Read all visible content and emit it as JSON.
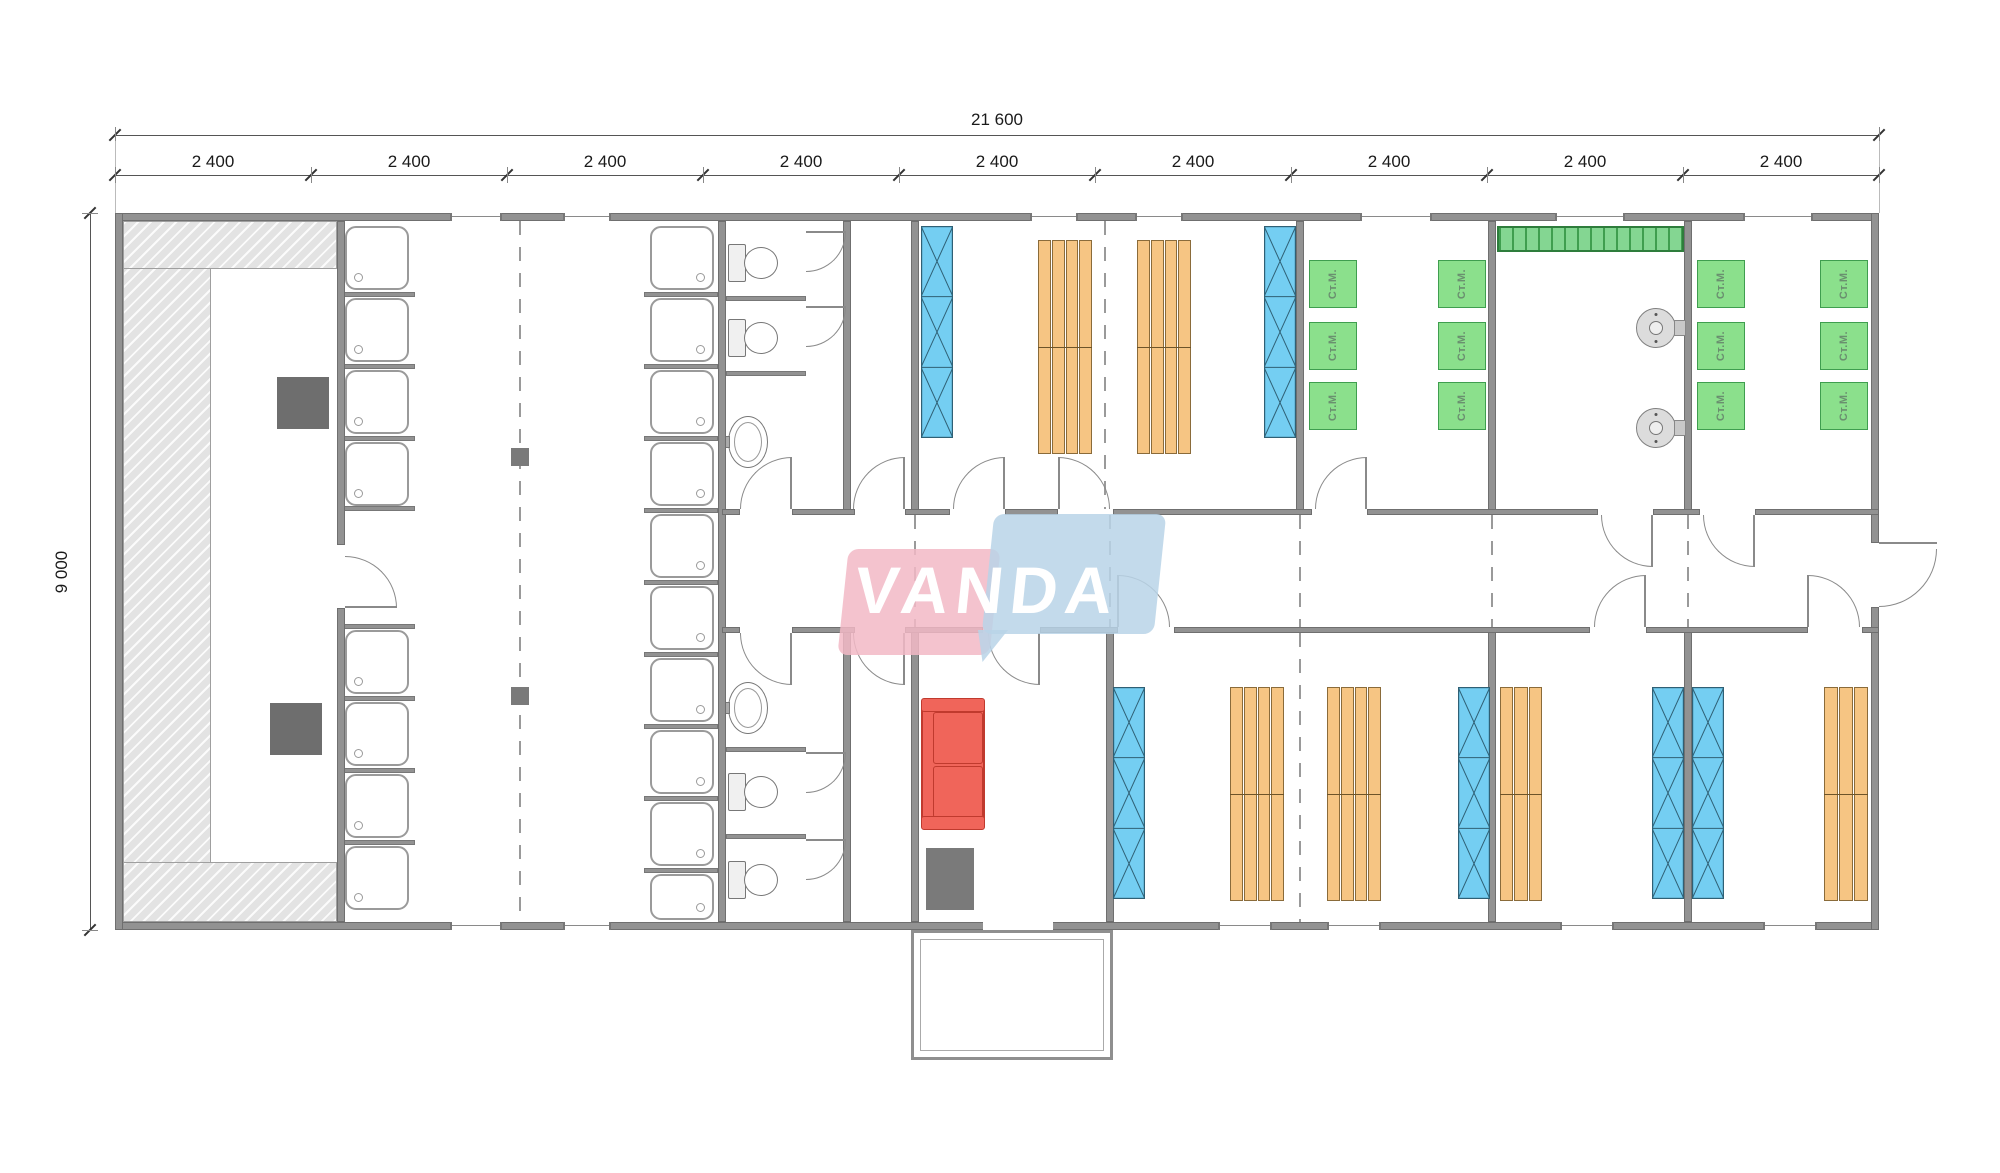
{
  "dimensions": {
    "total_width_label": "21 600",
    "height_label": "9 000",
    "segment_labels": [
      "2 400",
      "2 400",
      "2 400",
      "2 400",
      "2 400",
      "2 400",
      "2 400",
      "2 400",
      "2 400"
    ]
  },
  "watermark": {
    "text": "VANDA",
    "pink_color": "#f2b9c6",
    "blue_color": "#b9d3e8",
    "text_color": "#ffffff"
  },
  "fixture_labels": {
    "washing_machine": "Ст.М."
  },
  "colors": {
    "wall": "#929292",
    "locker_blue": "#74cef2",
    "locker_line": "#2f6075",
    "bed_orange": "#f6c583",
    "washer_green": "#8be08c",
    "sofa_red": "#f0655a",
    "bench_gray": "#e3e3e3",
    "drying_green": "#84d692",
    "dimension_text": "#1a1a1a"
  }
}
